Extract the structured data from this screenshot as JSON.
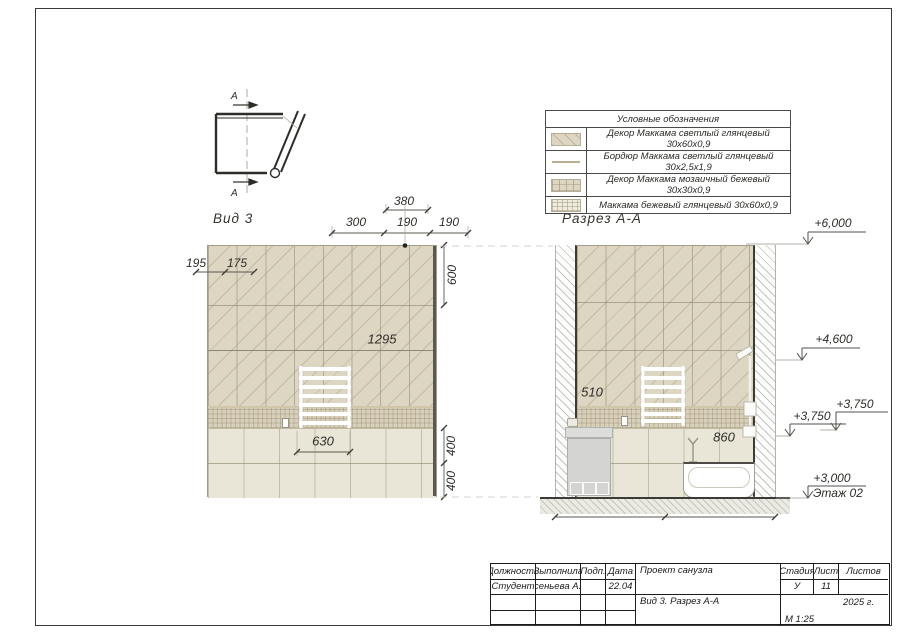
{
  "plan": {
    "section_letter_top": "А",
    "section_letter_bottom": "А"
  },
  "legend": {
    "title": "Условные обозначения",
    "rows": [
      {
        "label": "Декор Маккама светлый глянцевый 30х60х0,9"
      },
      {
        "label": "Бордюр Маккама светлый глянцевый 30х2,5х1,9"
      },
      {
        "label": "Декор Маккама мозаичный бежевый 30х30х0,9"
      },
      {
        "label": "Маккама бежевый глянцевый 30х60х0,9"
      }
    ]
  },
  "view3": {
    "title": "Вид 3",
    "dim_380": "380",
    "dim_300": "300",
    "dim_190a": "190",
    "dim_190b": "190",
    "dim_195": "195",
    "dim_175": "175",
    "dim_600": "600",
    "dim_1295": "1295",
    "dim_630": "630",
    "dim_400a": "400",
    "dim_400b": "400"
  },
  "section": {
    "title": "Разрез А-А",
    "dim_510": "510",
    "dim_860": "860"
  },
  "levels": {
    "l6000": "+6,000",
    "l4600": "+4,600",
    "l3750a": "+3,750",
    "l3750b": "+3,750",
    "l3000": "+3,000",
    "floor_label": "Этаж 02"
  },
  "titleblock": {
    "h_role": "Должность",
    "h_done_by": "Выполнила",
    "h_sign": "Подп.",
    "h_date": "Дата",
    "v_role": "Студент",
    "v_name": "Арсеньева А.Ю.",
    "v_date": "22.04",
    "project": "Проект санузла",
    "drawing": "Вид 3. Разрез А-А",
    "h_stage": "Стадия",
    "h_sheet": "Лист",
    "h_sheets": "Листов",
    "v_stage": "У",
    "v_sheet": "11",
    "year": "2025 г.",
    "scale": "М 1:25"
  },
  "colors": {
    "tile_decor": "#ddd6c2",
    "tile_mosaic": "#d8d0ba",
    "tile_field": "#e9e6d8",
    "line_dark": "#3c3a34",
    "dim_text": "#2e2d29"
  }
}
